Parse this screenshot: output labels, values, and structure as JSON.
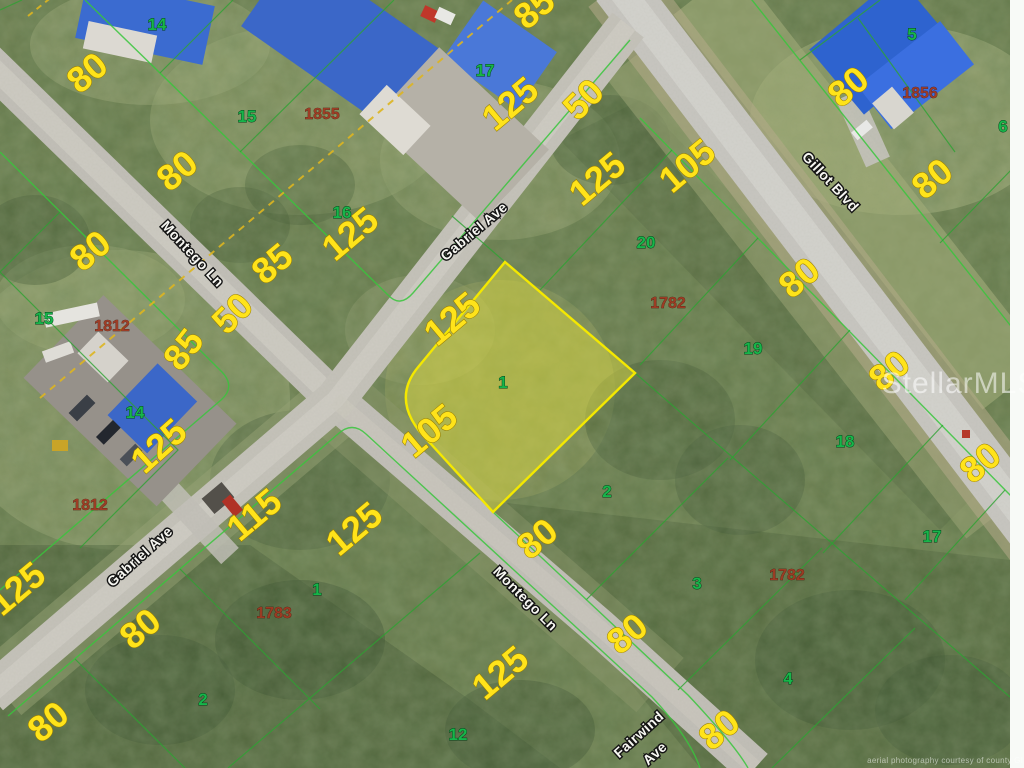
{
  "watermark": {
    "text": "StellarMLS"
  },
  "copyright": {
    "text": "aerial photography courtesy of county GIS"
  },
  "colors": {
    "dimension_yellow": "#ffe31a",
    "lot_green": "#17b54a",
    "parcel_red": "#9e3922",
    "boundary_green": "#38c53c",
    "subject_fill": "rgba(228,224,62,0.45)",
    "subject_stroke": "#f4e800",
    "road_gray": "#c6c3ba",
    "easement_dash_yellow": "#ddb520"
  },
  "subject_parcel": {
    "lot_number": "1",
    "frontage": "105",
    "depth": "125"
  },
  "street_labels": [
    {
      "id": "street-montego-ln-nw",
      "text": "Montego Ln",
      "x": 189,
      "y": 257,
      "rot": 47
    },
    {
      "id": "street-gabriel-ave-n",
      "text": "Gabriel Ave",
      "x": 477,
      "y": 235,
      "rot": -40
    },
    {
      "id": "street-gillot-blvd",
      "text": "Gillot Blvd",
      "x": 827,
      "y": 185,
      "rot": 47
    },
    {
      "id": "street-gabriel-ave-s",
      "text": "Gabriel Ave",
      "x": 143,
      "y": 560,
      "rot": -42
    },
    {
      "id": "street-montego-ln-se",
      "text": "Montego Ln",
      "x": 522,
      "y": 602,
      "rot": 45
    },
    {
      "id": "street-fairwind-ave-line1",
      "text": "Fairwind",
      "x": 642,
      "y": 738,
      "rot": -42
    },
    {
      "id": "street-fairwind-ave-line2",
      "text": "Ave",
      "x": 658,
      "y": 757,
      "rot": -42
    }
  ],
  "dimension_labels": [
    {
      "text": "80",
      "x": 95,
      "y": 82,
      "rot": -40
    },
    {
      "text": "80",
      "x": 185,
      "y": 180,
      "rot": -40
    },
    {
      "text": "85",
      "x": 280,
      "y": 273,
      "rot": -40
    },
    {
      "text": "125",
      "x": 358,
      "y": 243,
      "rot": -40
    },
    {
      "text": "80",
      "x": 98,
      "y": 260,
      "rot": -40
    },
    {
      "text": "50",
      "x": 241,
      "y": 322,
      "rot": -45,
      "size": 46
    },
    {
      "text": "85",
      "x": 193,
      "y": 357,
      "rot": -52
    },
    {
      "text": "125",
      "x": 167,
      "y": 455,
      "rot": -42
    },
    {
      "text": "85",
      "x": 542,
      "y": 18,
      "rot": -40
    },
    {
      "text": "125",
      "x": 518,
      "y": 113,
      "rot": -40
    },
    {
      "text": "50",
      "x": 592,
      "y": 108,
      "rot": -45,
      "size": 42
    },
    {
      "text": "125",
      "x": 605,
      "y": 188,
      "rot": -40
    },
    {
      "text": "105",
      "x": 695,
      "y": 175,
      "rot": -40
    },
    {
      "text": "80",
      "x": 856,
      "y": 96,
      "rot": -40
    },
    {
      "text": "80",
      "x": 940,
      "y": 188,
      "rot": -40
    },
    {
      "text": "80",
      "x": 807,
      "y": 287,
      "rot": -40
    },
    {
      "text": "80",
      "x": 897,
      "y": 380,
      "rot": -40
    },
    {
      "text": "80",
      "x": 988,
      "y": 472,
      "rot": -40
    },
    {
      "text": "125",
      "x": 460,
      "y": 328,
      "rot": -40
    },
    {
      "text": "105",
      "x": 437,
      "y": 440,
      "rot": -40
    },
    {
      "text": "115",
      "x": 262,
      "y": 524,
      "rot": -40
    },
    {
      "text": "125",
      "x": 25,
      "y": 598,
      "rot": -40
    },
    {
      "text": "80",
      "x": 148,
      "y": 638,
      "rot": -40
    },
    {
      "text": "80",
      "x": 56,
      "y": 731,
      "rot": -40
    },
    {
      "text": "125",
      "x": 362,
      "y": 538,
      "rot": -40
    },
    {
      "text": "80",
      "x": 545,
      "y": 548,
      "rot": -40
    },
    {
      "text": "80",
      "x": 635,
      "y": 643,
      "rot": -40
    },
    {
      "text": "125",
      "x": 508,
      "y": 682,
      "rot": -40
    },
    {
      "text": "80",
      "x": 727,
      "y": 739,
      "rot": -40
    },
    {
      "text": "80",
      "x": -14,
      "y": 170,
      "rot": -40
    }
  ],
  "lot_numbers": [
    {
      "text": "14",
      "x": 157,
      "y": 30
    },
    {
      "text": "15",
      "x": 247,
      "y": 122
    },
    {
      "text": "16",
      "x": 342,
      "y": 218
    },
    {
      "text": "17",
      "x": 485,
      "y": 76
    },
    {
      "text": "5",
      "x": 912,
      "y": 40
    },
    {
      "text": "6",
      "x": 1003,
      "y": 132
    },
    {
      "text": "20",
      "x": 646,
      "y": 248
    },
    {
      "text": "19",
      "x": 753,
      "y": 354
    },
    {
      "text": "18",
      "x": 845,
      "y": 447
    },
    {
      "text": "17",
      "x": 932,
      "y": 542
    },
    {
      "text": "15",
      "x": 44,
      "y": 324
    },
    {
      "text": "14",
      "x": 135,
      "y": 418
    },
    {
      "text": "1",
      "x": 503,
      "y": 388
    },
    {
      "text": "2",
      "x": 607,
      "y": 497
    },
    {
      "text": "3",
      "x": 697,
      "y": 589
    },
    {
      "text": "4",
      "x": 788,
      "y": 684
    },
    {
      "text": "1",
      "x": 317,
      "y": 595
    },
    {
      "text": "2",
      "x": 203,
      "y": 705
    },
    {
      "text": "12",
      "x": 458,
      "y": 740
    }
  ],
  "parcel_ids": [
    {
      "text": "1855",
      "x": 322,
      "y": 119
    },
    {
      "text": "1856",
      "x": 920,
      "y": 98
    },
    {
      "text": "1782",
      "x": 668,
      "y": 308
    },
    {
      "text": "1782",
      "x": 787,
      "y": 580
    },
    {
      "text": "1812",
      "x": 112,
      "y": 331
    },
    {
      "text": "1812",
      "x": 90,
      "y": 510
    },
    {
      "text": "1783",
      "x": 274,
      "y": 618
    }
  ]
}
